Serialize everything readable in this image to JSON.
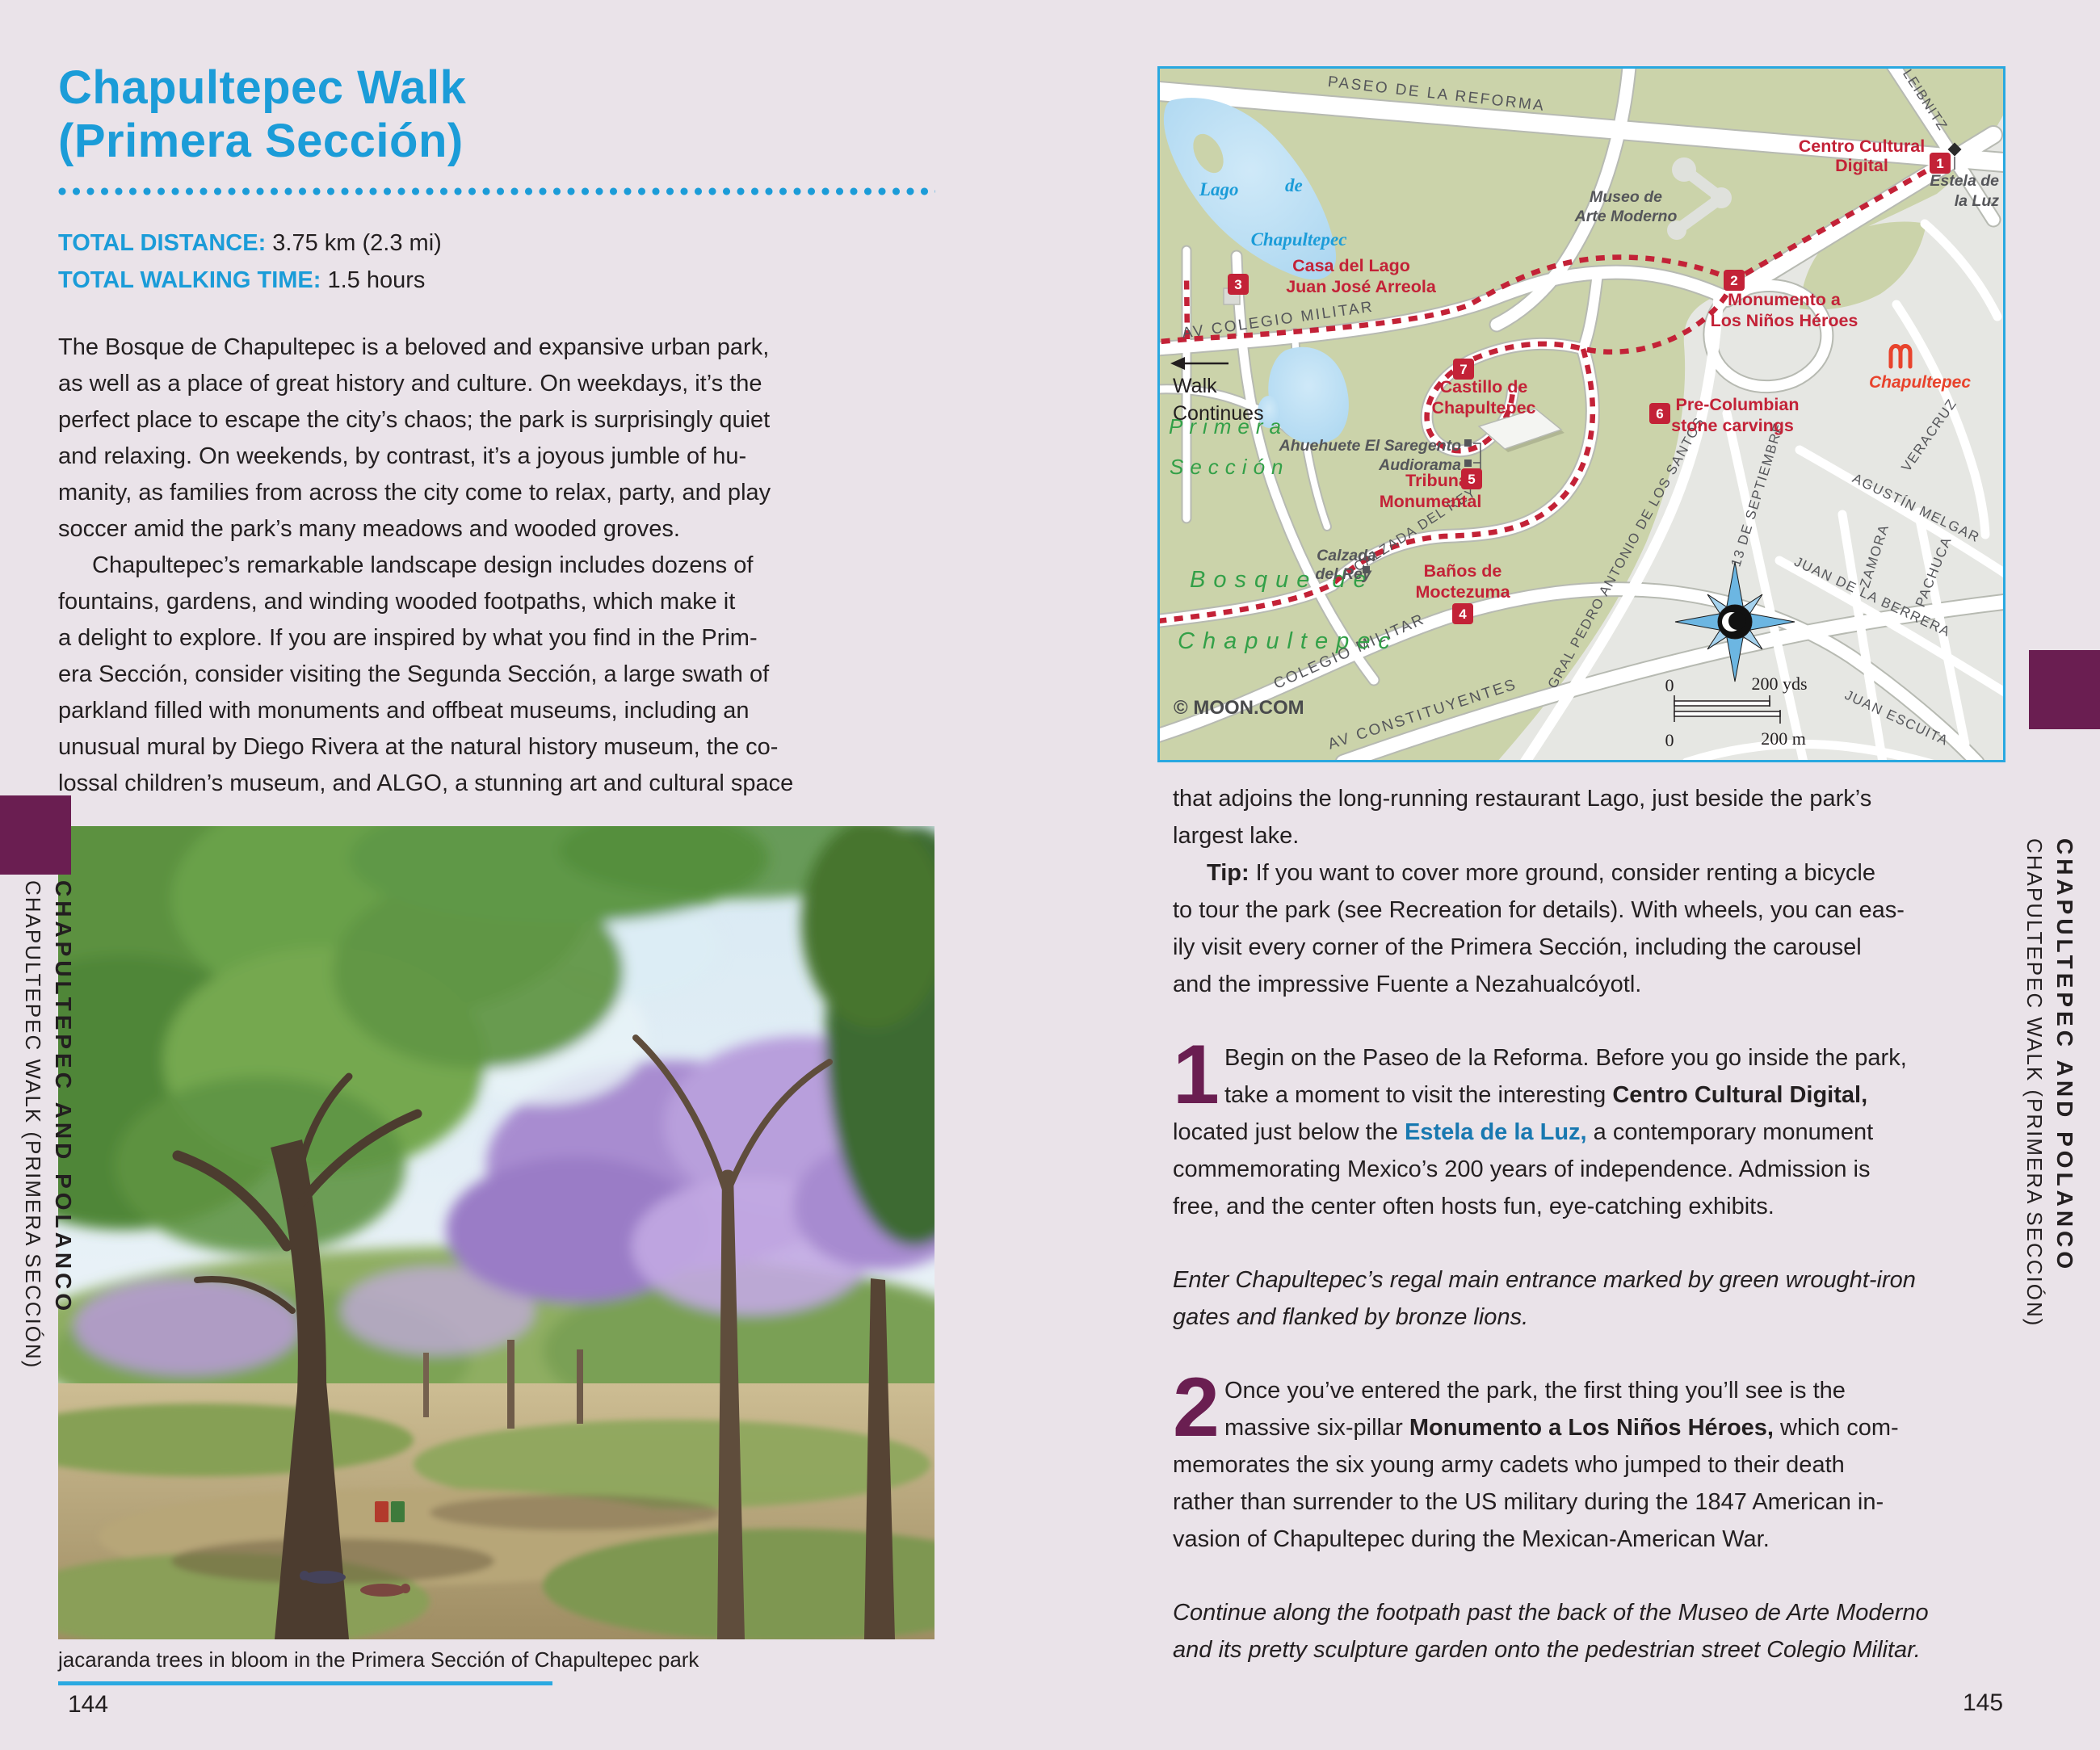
{
  "colors": {
    "accent_blue": "#1b9cd8",
    "purple_tab": "#6a1e51",
    "map_red": "#c32237",
    "link_blue": "#1878b0",
    "rule_blue": "#2aa9e1"
  },
  "left_page": {
    "title_line1": "Chapultepec Walk",
    "title_line2": "(Primera Sección)",
    "stat1_label": "TOTAL DISTANCE:",
    "stat1_value": "3.75 km (2.3 mi)",
    "stat2_label": "TOTAL WALKING TIME:",
    "stat2_value": "1.5 hours",
    "para1": "The Bosque de Chapultepec is a beloved and expansive urban park,\nas well as a place of great history and culture. On weekdays, it’s the\nperfect place to escape the city’s chaos; the park is surprisingly quiet\nand relaxing. On weekends, by contrast, it’s a joyous jumble of hu-\nmanity, as families from across the city come to relax, party, and play\nsoccer amid the park’s many meadows and wooded groves.",
    "para2": "Chapultepec’s remarkable landscape design includes dozens of\nfountains, gardens, and winding wooded footpaths, which make it\na delight to explore. If you are inspired by what you find in the Prim-\nera Sección, consider visiting the Segunda Sección, a large swath of\nparkland filled with monuments and offbeat museums, including an\nunusual mural by Diego Rivera at the natural history museum, the co-\nlossal children’s museum, and ALGO, a stunning art and cultural space",
    "photo_caption": "jacaranda trees in bloom in the Primera Sección of Chapultepec park",
    "page_number": "144",
    "sidebar_bold": "CHAPULTEPEC AND POLANCO",
    "sidebar_light": "CHAPULTEPEC WALK (PRIMERA SECCIÓN)"
  },
  "right_page": {
    "para_top": "that adjoins the long-running restaurant Lago, just beside the park’s\nlargest lake.",
    "tip_runs": [
      {
        "t": "Tip:",
        "b": true
      },
      {
        "t": " If you want to cover more ground, consider renting a bicycle\nto tour the park (see Recreation for details). With wheels, you can eas-\nily visit every corner of the Primera Sección, including the carousel\nand the impressive Fuente a Nezahualcóyotl."
      }
    ],
    "step1_number": "1",
    "step1_runs": [
      {
        "t": "Begin on the Paseo de la Reforma. Before you go inside the park,\ntake a moment to visit the interesting "
      },
      {
        "t": "Centro Cultural Digital,",
        "b": true
      },
      {
        "t": "\nlocated just below the "
      },
      {
        "t": "Estela de la Luz,",
        "link": true
      },
      {
        "t": " a contemporary monument\ncommemorating Mexico’s 200 years of independence. Admission is\nfree, and the center often hosts fun, eye-catching exhibits."
      }
    ],
    "italic1": "Enter Chapultepec’s regal main entrance marked by green wrought-iron\ngates and flanked by bronze lions.",
    "step2_number": "2",
    "step2_runs": [
      {
        "t": "Once you’ve entered the park, the first thing you’ll see is the\nmassive six-pillar "
      },
      {
        "t": "Monumento a Los Niños Héroes,",
        "b": true
      },
      {
        "t": " which com-\nmemorates the six young army cadets who jumped to their death\nrather than surrender to the US military during the 1847 American in-\nvasion of Chapultepec during the Mexican-American War."
      }
    ],
    "italic2": "Continue along the footpath past the back of the Museo de Arte Moderno\nand its pretty sculpture garden onto the pedestrian street Colegio Militar.",
    "page_number": "145",
    "sidebar_bold": "CHAPULTEPEC AND POLANCO",
    "sidebar_light": "CHAPULTEPEC WALK (PRIMERA SECCIÓN)"
  },
  "map": {
    "attribution": "© MOON.COM",
    "walk1": "Walk",
    "walk2": "Continues",
    "area1": "Primera",
    "area2": "Sección",
    "area3": "Bosque de",
    "area4": "Chapultepec",
    "lake1a": "Lago",
    "lake1b": "de",
    "lake1c": "Chapultepec",
    "st_reforma": "PASEO DE LA REFORMA",
    "st_leibnitz": "LEIBNITZ",
    "st_colegio_av": "AV COLEGIO MILITAR",
    "st_calzada": "CALZADA DEL REY",
    "st_colegio": "COLEGIO MILITAR",
    "st_constituyentes": "AV CONSTITUYENTES",
    "st_gral": "GRAL PEDRO ANTONIO DE LOS SANTOS",
    "st_septiembre": "13 DE SEPTIEMBRE",
    "st_veracruz": "VERACRUZ",
    "st_melgar": "AGUSTÍN MELGAR",
    "st_zamora": "ZAMORA",
    "st_pachuca": "PACHUCA",
    "st_barrera": "JUAN DE LA BERRERA",
    "st_escuita": "JUAN ESCUITA",
    "poi_centro1": "Centro Cultural",
    "poi_centro2": "Digital",
    "poi_estela1": "Estela de",
    "poi_estela2": "la Luz",
    "poi_monu1": "Monumento a",
    "poi_monu2": "Los Niños Héroes",
    "poi_casa1": "Casa del Lago",
    "poi_casa2": "Juan José Arreola",
    "poi_museo1": "Museo de",
    "poi_museo2": "Arte Moderno",
    "poi_castillo1": "Castillo de",
    "poi_castillo2": "Chapultepec",
    "poi_precol1": "Pre-Columbian",
    "poi_precol2": "stone carvings",
    "poi_ahue": "Ahuehuete El Saregento",
    "poi_audio": "Audiorama",
    "poi_tribuna1": "Tribuna",
    "poi_tribuna2": "Monumental",
    "poi_calzada1": "Calzada",
    "poi_calzada2": "del Rey",
    "poi_banos1": "Baños de",
    "poi_banos2": "Moctezuma",
    "poi_metro": "Chapultepec",
    "m1": "1",
    "m2": "2",
    "m3": "3",
    "m4": "4",
    "m5": "5",
    "m6": "6",
    "m7": "7",
    "scale_zero1": "0",
    "scale_yds": "200 yds",
    "scale_zero2": "0",
    "scale_m": "200 m"
  }
}
